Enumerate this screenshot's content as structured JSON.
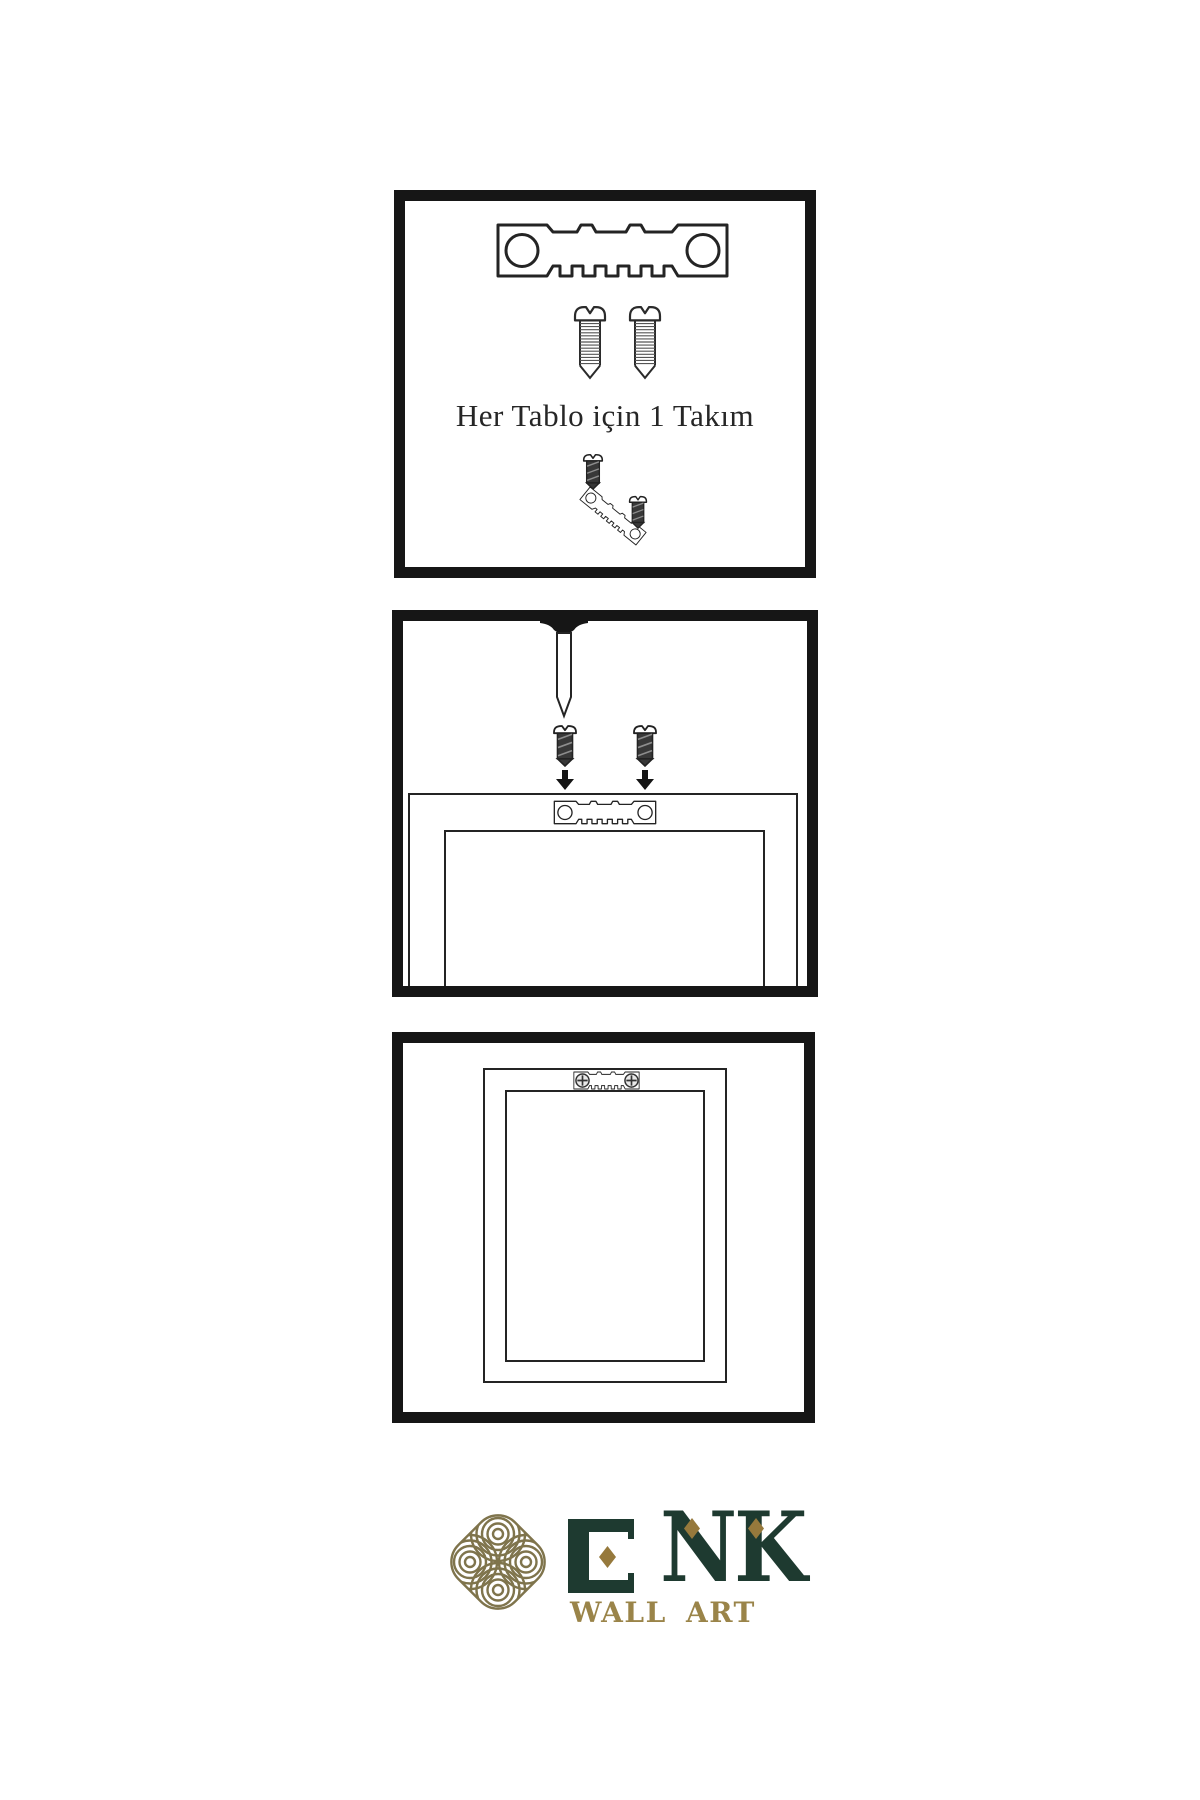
{
  "steps": {
    "kit": {
      "caption": "Her Tablo için 1 Takım",
      "icons": [
        "sawtooth-hanger-icon",
        "screw-icon",
        "screw-icon",
        "screw-dark-icon",
        "tilted-sawtooth-hanger-icon",
        "screw-dark-icon"
      ]
    },
    "install": {
      "icons": [
        "nail-icon",
        "screw-dark-icon",
        "screw-dark-icon",
        "down-arrow-icon",
        "down-arrow-icon",
        "frame-back-outline",
        "sawtooth-hanger-icon"
      ]
    },
    "result": {
      "icons": [
        "frame-back-outline",
        "sawtooth-hanger-icon",
        "phillips-screw-head-icon",
        "phillips-screw-head-icon"
      ]
    }
  },
  "logo": {
    "brand": "ENK",
    "letters": [
      "E",
      "N",
      "K"
    ],
    "tagline": "WALL ART",
    "icon": "knot-icon"
  },
  "colors": {
    "ink": "#242424",
    "panel_border": "#161616",
    "logo_green": "#1e3a30",
    "logo_gold": "#96793c",
    "logo_olive": "#7f744c",
    "tagline_gold": "#9a8449",
    "screw_dark": "#383838"
  }
}
